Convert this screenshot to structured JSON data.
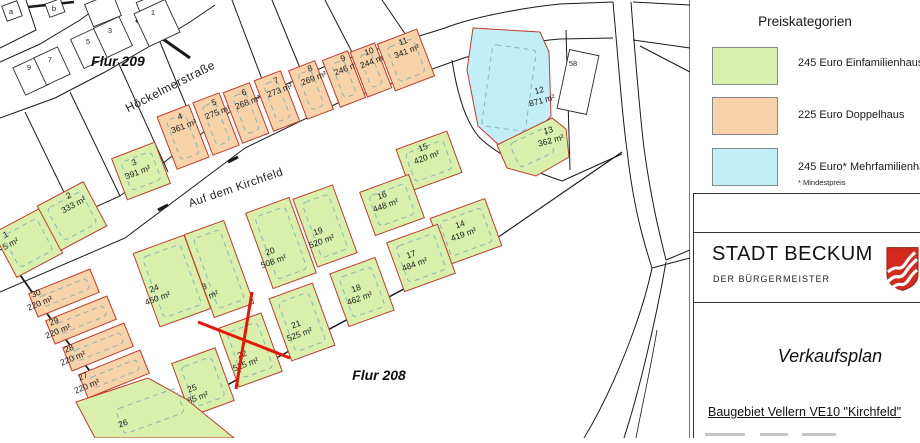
{
  "legend": {
    "title": "Preiskategorien",
    "entries": [
      {
        "label": "245 Euro Einfamilienhaus",
        "color": "#d9f0ad"
      },
      {
        "label": "225 Euro Doppelhaus",
        "color": "#f8d2a9"
      },
      {
        "label": "245 Euro* Mehrfamilienhaus",
        "color": "#c2eff7"
      }
    ],
    "footnote": "* Mindestpreis"
  },
  "title_block": {
    "city": "STADT BECKUM",
    "subtitle": "DER BÜRGERMEISTER",
    "plan_title": "Verkaufsplan",
    "project": "Baugebiet Vellern VE10 \"Kirchfeld\""
  },
  "map": {
    "flur_labels": [
      {
        "text": "Flur 209",
        "x": 118,
        "y": 66
      },
      {
        "text": "Flur 208",
        "x": 379,
        "y": 380
      }
    ],
    "streets": [
      {
        "name": "Höckelmerstraße",
        "x": 172,
        "y": 90,
        "angle": -27,
        "size": 12
      },
      {
        "name": "Auf dem Kirchfeld",
        "x": 237,
        "y": 191,
        "angle": -19,
        "size": 11.5
      }
    ],
    "category_colors": {
      "einfamilienhaus": "#d9f0ad",
      "doppelhaus": "#f8d2a9",
      "mehrfamilienhaus": "#c2eff7"
    },
    "plots": [
      {
        "no": "1",
        "area": "5 m²",
        "cat": "einfamilienhaus",
        "cx": 28,
        "cy": 243,
        "w": 52,
        "h": 50,
        "angle": -28,
        "lx": 7,
        "ly": 237
      },
      {
        "no": "2",
        "area": "333 m²",
        "cat": "einfamilienhaus",
        "cx": 72,
        "cy": 216,
        "w": 52,
        "h": 50,
        "angle": -28,
        "lx": 70,
        "ly": 198
      },
      {
        "no": "3",
        "area": "391 m²",
        "cat": "einfamilienhaus",
        "cx": 141,
        "cy": 171,
        "w": 46,
        "h": 44,
        "angle": -21,
        "lx": 135,
        "ly": 165
      },
      {
        "no": "4",
        "area": "361 m²",
        "cat": "doppelhaus",
        "cx": 183,
        "cy": 137,
        "w": 34,
        "h": 56,
        "angle": -21,
        "lx": 181,
        "ly": 119
      },
      {
        "no": "5",
        "area": "275 m²",
        "cat": "doppelhaus",
        "cx": 216,
        "cy": 124,
        "w": 28,
        "h": 56,
        "angle": -21,
        "lx": 215,
        "ly": 105
      },
      {
        "no": "6",
        "area": "268 m²",
        "cat": "doppelhaus",
        "cx": 246,
        "cy": 113,
        "w": 28,
        "h": 54,
        "angle": -21,
        "lx": 245,
        "ly": 95
      },
      {
        "no": "7",
        "area": "273 m²",
        "cat": "doppelhaus",
        "cx": 277,
        "cy": 101,
        "w": 28,
        "h": 54,
        "angle": -21,
        "lx": 277,
        "ly": 83
      },
      {
        "no": "8",
        "area": "269 m²",
        "cat": "doppelhaus",
        "cx": 311,
        "cy": 90,
        "w": 28,
        "h": 52,
        "angle": -21,
        "lx": 311,
        "ly": 71
      },
      {
        "no": "9",
        "area": "246 m²",
        "cat": "doppelhaus",
        "cx": 344,
        "cy": 79,
        "w": 27,
        "h": 50,
        "angle": -21,
        "lx": 344,
        "ly": 61
      },
      {
        "no": "10",
        "area": "244 m²",
        "cat": "doppelhaus",
        "cx": 371,
        "cy": 70,
        "w": 26,
        "h": 48,
        "angle": -21,
        "lx": 370,
        "ly": 54
      },
      {
        "no": "11",
        "area": "341 m²",
        "cat": "doppelhaus",
        "cx": 406,
        "cy": 60,
        "w": 42,
        "h": 50,
        "angle": -21,
        "lx": 404,
        "ly": 44
      },
      {
        "no": "12",
        "area": "871 m²",
        "cat": "mehrfamilienhaus",
        "poly": "M473,28 L540,32 L549,52 L551,116 L536,133 L500,146 L478,126 L467,70 Z",
        "lx": 540,
        "ly": 93,
        "angle": -15
      },
      {
        "no": "13",
        "area": "362 m²",
        "cat": "einfamilienhaus",
        "poly": "M497,145 L552,118 L566,129 L569,157 L536,176 L507,168 Z",
        "lx": 549,
        "ly": 133,
        "angle": -15
      },
      {
        "no": "14",
        "area": "419 m²",
        "cat": "einfamilienhaus",
        "cx": 466,
        "cy": 232,
        "w": 58,
        "h": 50,
        "angle": -20,
        "lx": 461,
        "ly": 227
      },
      {
        "no": "15",
        "area": "420 m²",
        "cat": "einfamilienhaus",
        "cx": 429,
        "cy": 161,
        "w": 54,
        "h": 44,
        "angle": -20,
        "lx": 424,
        "ly": 150
      },
      {
        "no": "16",
        "area": "448 m²",
        "cat": "einfamilienhaus",
        "cx": 392,
        "cy": 205,
        "w": 52,
        "h": 46,
        "angle": -20,
        "lx": 383,
        "ly": 198
      },
      {
        "no": "17",
        "area": "484 m²",
        "cat": "einfamilienhaus",
        "cx": 421,
        "cy": 258,
        "w": 54,
        "h": 52,
        "angle": -20,
        "lx": 412,
        "ly": 257
      },
      {
        "no": "18",
        "area": "462 m²",
        "cat": "einfamilienhaus",
        "cx": 362,
        "cy": 292,
        "w": 48,
        "h": 56,
        "angle": -20,
        "lx": 357,
        "ly": 291
      },
      {
        "no": "19",
        "area": "520 m²",
        "cat": "einfamilienhaus",
        "cx": 325,
        "cy": 226,
        "w": 42,
        "h": 72,
        "angle": -20,
        "lx": 319,
        "ly": 234
      },
      {
        "no": "20",
        "area": "508 m²",
        "cat": "einfamilienhaus",
        "cx": 281,
        "cy": 243,
        "w": 46,
        "h": 80,
        "angle": -20,
        "lx": 271,
        "ly": 254
      },
      {
        "no": "21",
        "area": "525 m²",
        "cat": "einfamilienhaus",
        "cx": 302,
        "cy": 322,
        "w": 46,
        "h": 66,
        "angle": -20,
        "lx": 297,
        "ly": 327
      },
      {
        "no": "22",
        "area": "525 m²",
        "cat": "einfamilienhaus",
        "cx": 250,
        "cy": 350,
        "w": 46,
        "h": 62,
        "angle": -20,
        "lx": 243,
        "ly": 357
      },
      {
        "no": "23",
        "area": "535 m²",
        "cat": "einfamilienhaus",
        "cx": 219,
        "cy": 269,
        "w": 42,
        "h": 88,
        "angle": -20,
        "lx": 203,
        "ly": 290
      },
      {
        "no": "24",
        "area": "450 m²",
        "cat": "einfamilienhaus",
        "cx": 172,
        "cy": 281,
        "w": 54,
        "h": 78,
        "angle": -20,
        "lx": 155,
        "ly": 291
      },
      {
        "no": "25",
        "area": "485 m²",
        "cat": "einfamilienhaus",
        "cx": 203,
        "cy": 382,
        "w": 46,
        "h": 56,
        "angle": -20,
        "lx": 193,
        "ly": 391
      },
      {
        "no": "26",
        "area": "",
        "cat": "einfamilienhaus",
        "poly": "M76,402 L148,378 L186,399 L234,438 L95,438 Z",
        "lx": 124,
        "ly": 426,
        "angle": -20
      },
      {
        "no": "27",
        "area": "220 m²",
        "cat": "doppelhaus",
        "cx": 114,
        "cy": 374,
        "w": 66,
        "h": 25,
        "angle": -22,
        "lx": 84,
        "ly": 379
      },
      {
        "no": "28",
        "area": "220 m²",
        "cat": "doppelhaus",
        "cx": 98,
        "cy": 347,
        "w": 66,
        "h": 25,
        "angle": -22,
        "lx": 70,
        "ly": 351
      },
      {
        "no": "29",
        "area": "220 m²",
        "cat": "doppelhaus",
        "cx": 81,
        "cy": 320,
        "w": 66,
        "h": 25,
        "angle": -22,
        "lx": 55,
        "ly": 324
      },
      {
        "no": "30",
        "area": "220 m²",
        "cat": "doppelhaus",
        "cx": 64,
        "cy": 293,
        "w": 66,
        "h": 25,
        "angle": -22,
        "lx": 37,
        "ly": 296
      }
    ],
    "houses": [
      {
        "no": "a",
        "cx": 12,
        "cy": 11,
        "w": 16,
        "h": 16,
        "angle": -20,
        "lx": 11,
        "ly": 11
      },
      {
        "no": "b",
        "cx": 55,
        "cy": 8,
        "w": 16,
        "h": 14,
        "angle": -20,
        "lx": 54,
        "ly": 8
      },
      {
        "no": "",
        "cx": 103,
        "cy": 10,
        "w": 30,
        "h": 24,
        "angle": -22,
        "lx": 0,
        "ly": 0
      },
      {
        "no": "",
        "cx": 152,
        "cy": 7,
        "w": 26,
        "h": 20,
        "angle": -22,
        "lx": 0,
        "ly": 0
      },
      {
        "no": "9",
        "cx": 31,
        "cy": 76,
        "w": 26,
        "h": 30,
        "angle": -25,
        "lx": 29,
        "ly": 67
      },
      {
        "no": "7",
        "cx": 52,
        "cy": 66,
        "w": 26,
        "h": 30,
        "angle": -25,
        "lx": 50,
        "ly": 59
      },
      {
        "no": "5",
        "cx": 90,
        "cy": 48,
        "w": 28,
        "h": 32,
        "angle": -25,
        "lx": 88,
        "ly": 41
      },
      {
        "no": "3",
        "cx": 113,
        "cy": 37,
        "w": 28,
        "h": 32,
        "angle": -25,
        "lx": 110,
        "ly": 30
      },
      {
        "no": "1",
        "cx": 157,
        "cy": 23,
        "w": 34,
        "h": 36,
        "angle": -25,
        "lx": 153,
        "ly": 12
      },
      {
        "no": "58",
        "cx": 578,
        "cy": 82,
        "w": 30,
        "h": 60,
        "angle": 12,
        "lx": 573,
        "ly": 63
      }
    ],
    "sold_mark": {
      "plot_no": "22"
    }
  }
}
